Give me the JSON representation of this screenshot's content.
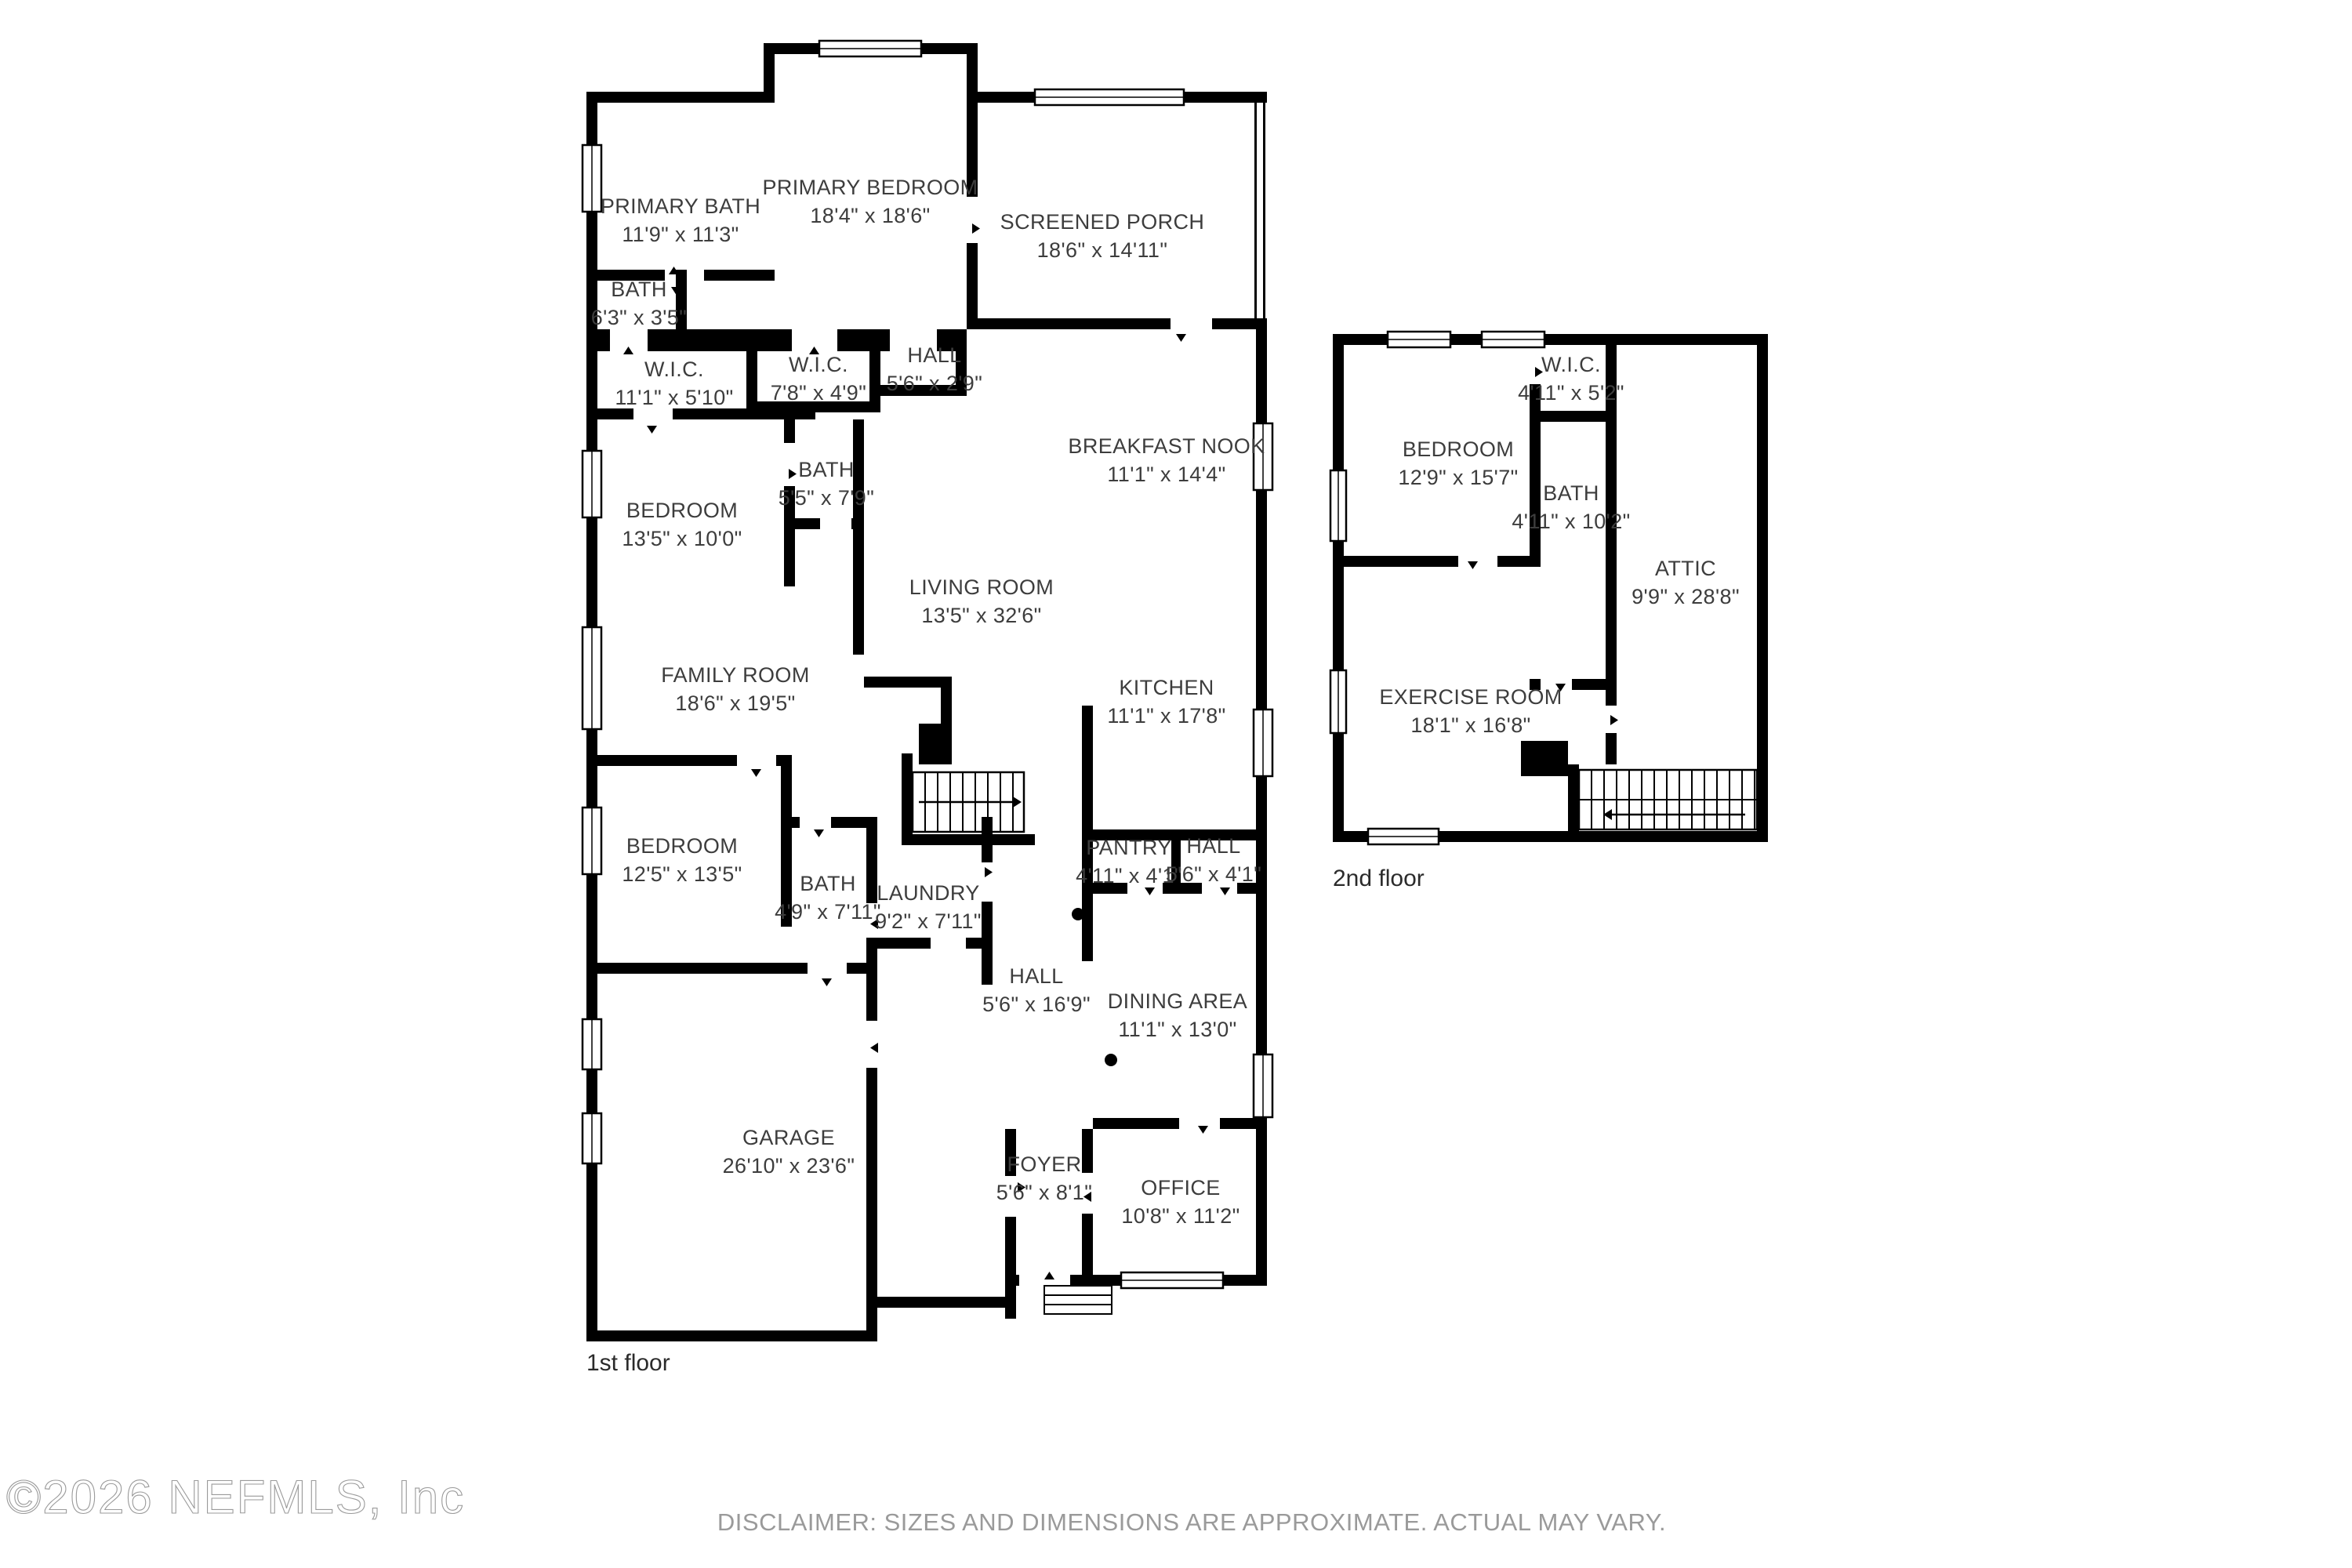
{
  "document": {
    "type": "residential-floor-plan",
    "copyright": "©2026 NEFMLS, Inc",
    "disclaimer": "DISCLAIMER: SIZES AND DIMENSIONS ARE APPROXIMATE. ACTUAL MAY VARY."
  },
  "colors": {
    "wall": "#000000",
    "label": "#3d3d3d",
    "muted": "#9a9a9a",
    "background": "#ffffff"
  },
  "floors": [
    {
      "id": "first",
      "label": "1st floor",
      "rooms": [
        {
          "id": "primary-bath",
          "name": "PRIMARY BATH",
          "dims": "11'9\" x 11'3\""
        },
        {
          "id": "primary-bedroom",
          "name": "PRIMARY BEDROOM",
          "dims": "18'4\" x 18'6\""
        },
        {
          "id": "screened-porch",
          "name": "SCREENED PORCH",
          "dims": "18'6\" x 14'11\""
        },
        {
          "id": "bath-small",
          "name": "BATH",
          "dims": "6'3\" x 3'5\""
        },
        {
          "id": "wic-1",
          "name": "W.I.C.",
          "dims": "11'1\" x 5'10\""
        },
        {
          "id": "wic-2",
          "name": "W.I.C.",
          "dims": "7'8\" x 4'9\""
        },
        {
          "id": "hall-small",
          "name": "HALL",
          "dims": "5'6\" x 2'9\""
        },
        {
          "id": "breakfast-nook",
          "name": "BREAKFAST NOOK",
          "dims": "11'1\" x 14'4\""
        },
        {
          "id": "bath-2",
          "name": "BATH",
          "dims": "5'5\" x 7'9\""
        },
        {
          "id": "bedroom-1",
          "name": "BEDROOM",
          "dims": "13'5\" x 10'0\""
        },
        {
          "id": "living-room",
          "name": "LIVING ROOM",
          "dims": "13'5\" x 32'6\""
        },
        {
          "id": "family-room",
          "name": "FAMILY ROOM",
          "dims": "18'6\" x 19'5\""
        },
        {
          "id": "kitchen",
          "name": "KITCHEN",
          "dims": "11'1\" x 17'8\""
        },
        {
          "id": "bedroom-2",
          "name": "BEDROOM",
          "dims": "12'5\" x 13'5\""
        },
        {
          "id": "bath-3",
          "name": "BATH",
          "dims": "4'9\" x 7'11\""
        },
        {
          "id": "laundry",
          "name": "LAUNDRY",
          "dims": "9'2\" x 7'11\""
        },
        {
          "id": "pantry",
          "name": "PANTRY",
          "dims": "4'11\" x 4'1\""
        },
        {
          "id": "hall-2",
          "name": "HALL",
          "dims": "5'6\" x 4'1\""
        },
        {
          "id": "hall-3",
          "name": "HALL",
          "dims": "5'6\" x 16'9\""
        },
        {
          "id": "dining-area",
          "name": "DINING AREA",
          "dims": "11'1\" x 13'0\""
        },
        {
          "id": "garage",
          "name": "GARAGE",
          "dims": "26'10\" x 23'6\""
        },
        {
          "id": "foyer",
          "name": "FOYER",
          "dims": "5'6\" x 8'1\""
        },
        {
          "id": "office",
          "name": "OFFICE",
          "dims": "10'8\" x 11'2\""
        }
      ]
    },
    {
      "id": "second",
      "label": "2nd floor",
      "rooms": [
        {
          "id": "wic-3",
          "name": "W.I.C.",
          "dims": "4'11\" x 5'2\""
        },
        {
          "id": "bedroom-3",
          "name": "BEDROOM",
          "dims": "12'9\" x 15'7\""
        },
        {
          "id": "bath-4",
          "name": "BATH",
          "dims": "4'11\" x 10'2\""
        },
        {
          "id": "attic",
          "name": "ATTIC",
          "dims": "9'9\" x 28'8\""
        },
        {
          "id": "exercise-room",
          "name": "EXERCISE ROOM",
          "dims": "18'1\" x 16'8\""
        }
      ]
    }
  ]
}
